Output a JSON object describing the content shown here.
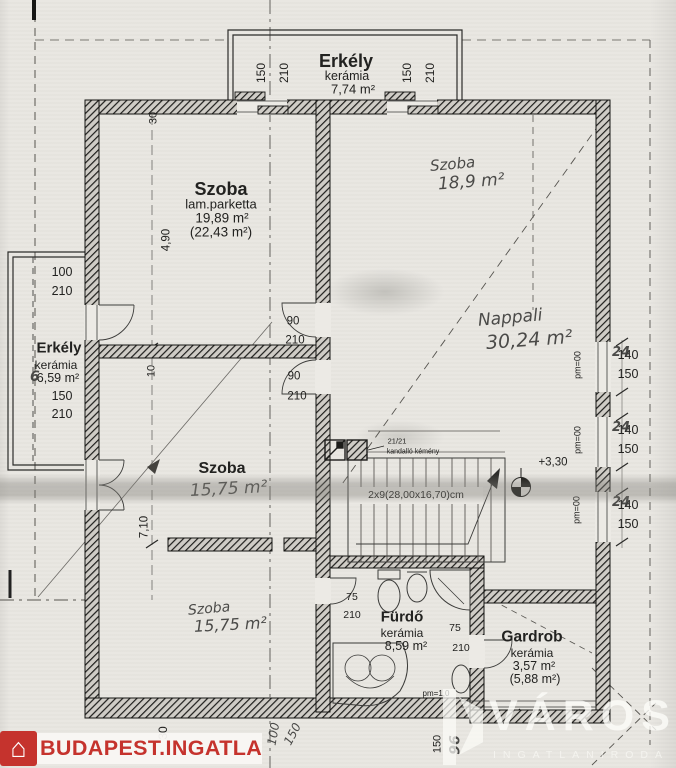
{
  "watermark": {
    "text": "BUDAPEST.INGATLAN.HU"
  },
  "agency": {
    "name": "VÁROSI",
    "subtitle": "INGATLANIRODA"
  },
  "rooms": {
    "balcony_top": {
      "name": "Erkély",
      "material": "kerámia",
      "area": "7,74 m²"
    },
    "room_nw": {
      "name": "Szoba",
      "material": "lam.parketta",
      "area": "19,89 m²",
      "area_alt": "(22,43 m²)"
    },
    "room_ne": {
      "name": "Szoba",
      "area": "18,9 m²"
    },
    "living": {
      "name": "Nappali",
      "area": "30,24 m²"
    },
    "balcony_left": {
      "name": "Erkély",
      "material": "kerámia",
      "area": "6,59 m²",
      "hand_digit": "6"
    },
    "room_w": {
      "name": "Szoba",
      "area": "15,75 m²"
    },
    "room_sw": {
      "name": "Szoba",
      "area": "15,75 m²"
    },
    "bath": {
      "name": "Fürdő",
      "material": "kerámia",
      "area": "8,59 m²"
    },
    "wardrobe": {
      "name": "Gardrob",
      "material": "kerámia",
      "area": "3,57 m²",
      "area_alt": "(5,88 m²)"
    }
  },
  "stairs": {
    "label": "2x9(28,00x16,70)cm"
  },
  "chimney": {
    "size": "21/21",
    "label": "kandalló kémény"
  },
  "level_mark": "+3,30",
  "dims": {
    "top_doors": [
      {
        "w": "150",
        "h": "210"
      },
      {
        "w": "150",
        "h": "210"
      }
    ],
    "left_doors": [
      {
        "w": "100",
        "h": "210"
      },
      {
        "w": "150",
        "h": "210"
      }
    ],
    "mid_doors": [
      {
        "w": "90",
        "h": "210"
      },
      {
        "w": "90",
        "h": "210"
      }
    ],
    "bath_door": {
      "w": "75",
      "h": "210"
    },
    "wardrobe_door": {
      "w": "75",
      "h": "210"
    },
    "right_windows": [
      {
        "w": "140",
        "h": "150",
        "pm": "pm=00",
        "hand": "24"
      },
      {
        "w": "140",
        "h": "150",
        "pm": "pm=00",
        "hand": "24"
      },
      {
        "w": "140",
        "h": "150",
        "pm": "pm=00",
        "hand": "24"
      }
    ],
    "left_chain": {
      "wall": "30",
      "a": "4,90",
      "b": "10",
      "c": "7,10"
    },
    "bottom": {
      "a": "30",
      "b": "100",
      "c": "150",
      "d": "150",
      "e": "96",
      "pm": "pm=1,0"
    }
  }
}
